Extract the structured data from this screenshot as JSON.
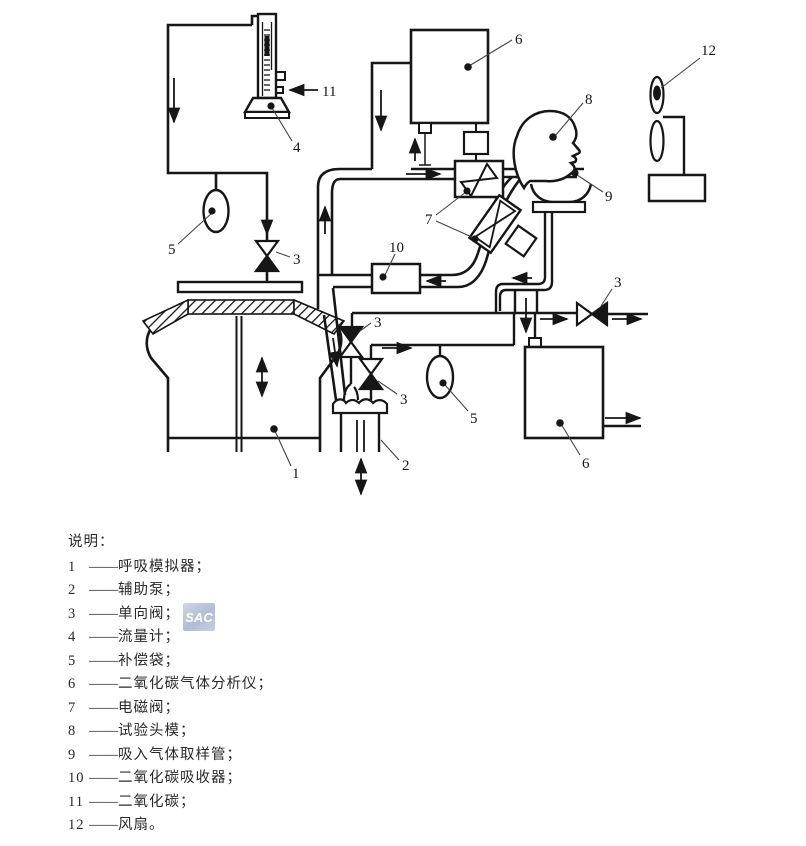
{
  "figure": {
    "watermark": "SAC",
    "labels": {
      "n1": "1",
      "n2": "2",
      "n3": "3",
      "n4": "4",
      "n5": "5",
      "n6": "6",
      "n7": "7",
      "n8": "8",
      "n9": "9",
      "n10": "10",
      "n11": "11",
      "n12": "12"
    },
    "legend": {
      "title": "说明：",
      "dash": "——",
      "items": [
        {
          "num": "1",
          "desc": "呼吸模拟器；"
        },
        {
          "num": "2",
          "desc": "辅助泵；"
        },
        {
          "num": "3",
          "desc": "单向阀；"
        },
        {
          "num": "4",
          "desc": "流量计；"
        },
        {
          "num": "5",
          "desc": "补偿袋；"
        },
        {
          "num": "6",
          "desc": "二氧化碳气体分析仪；"
        },
        {
          "num": "7",
          "desc": "电磁阀；"
        },
        {
          "num": "8",
          "desc": "试验头模；"
        },
        {
          "num": "9",
          "desc": "吸入气体取样管；"
        },
        {
          "num": "10",
          "desc": "二氧化碳吸收器；"
        },
        {
          "num": "11",
          "desc": "二氧化碳；"
        },
        {
          "num": "12",
          "desc": "风扇。"
        }
      ]
    }
  }
}
